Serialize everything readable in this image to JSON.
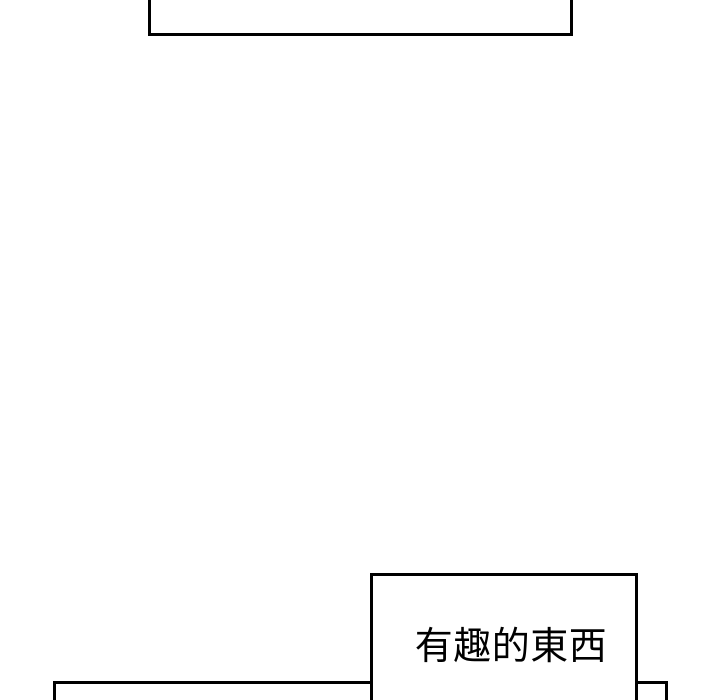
{
  "colors": {
    "page_background": "#ffffff",
    "line": "#000000"
  },
  "caption": {
    "text": "有趣的東西"
  }
}
